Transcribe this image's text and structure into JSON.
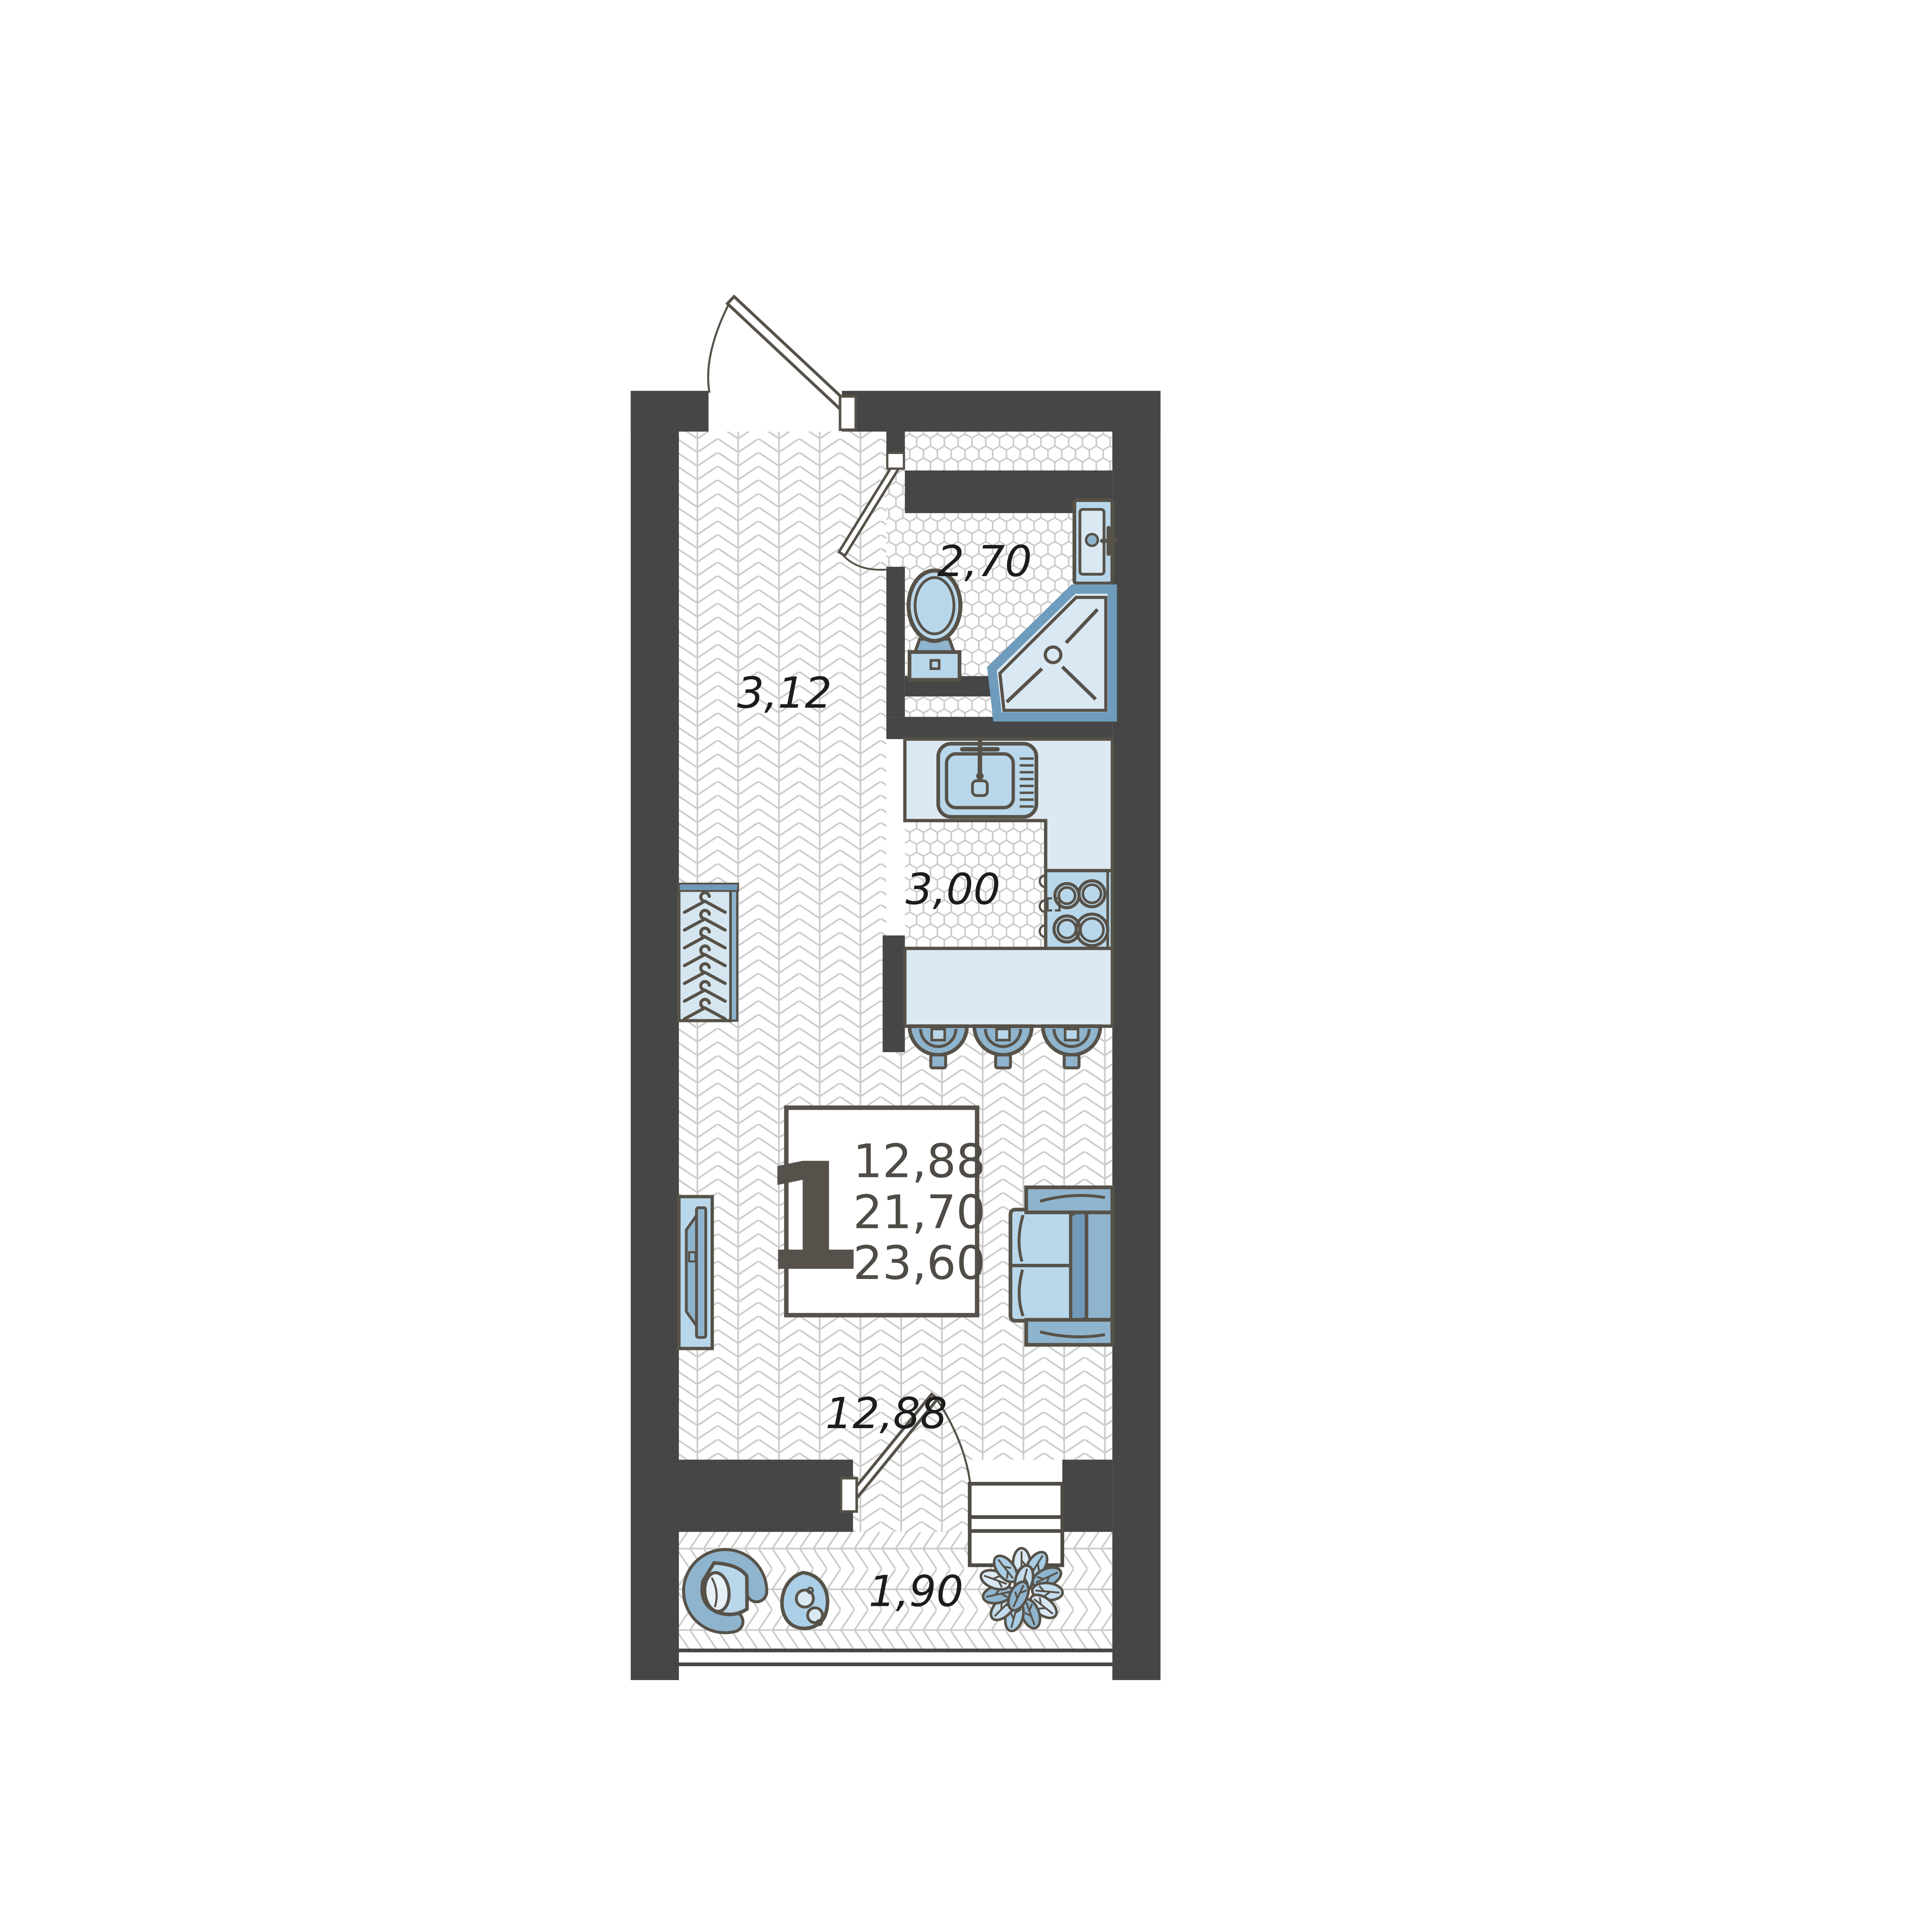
{
  "plan": {
    "type": "studio-apartment-floor-plan",
    "info_box": {
      "rooms_count": "1",
      "living_area": "12,88",
      "apartment_area": "21,70",
      "total_area": "23,60"
    },
    "rooms": [
      {
        "id": "hallway",
        "area_label": "3,12"
      },
      {
        "id": "bathroom",
        "area_label": "2,70"
      },
      {
        "id": "kitchen",
        "area_label": "3,00"
      },
      {
        "id": "living-room",
        "area_label": "12,88"
      },
      {
        "id": "balcony",
        "area_label": "1,90"
      }
    ],
    "fixtures": [
      "entrance-door",
      "bathroom-door",
      "balcony-door",
      "balcony-window",
      "bathroom-sink",
      "toilet",
      "shower",
      "kitchen-sink",
      "stove",
      "kitchen-counter",
      "bar-counter",
      "bar-stools",
      "wardrobe-hangers",
      "tv-console",
      "sofa",
      "lounge-chair",
      "side-table",
      "plant"
    ],
    "colors": {
      "wall": "#464646",
      "outline": "#575249",
      "fixture_light": "#b9d7ea",
      "fixture_mid": "#8fb4cd",
      "fixture_dark": "#7199ba",
      "counter_fill": "#dce9f2",
      "tray_fill": "#d9e8f3",
      "floor_line": "#cbcbcb",
      "label_text": "#1c1c1c",
      "info_text": "#4f4b46"
    }
  }
}
